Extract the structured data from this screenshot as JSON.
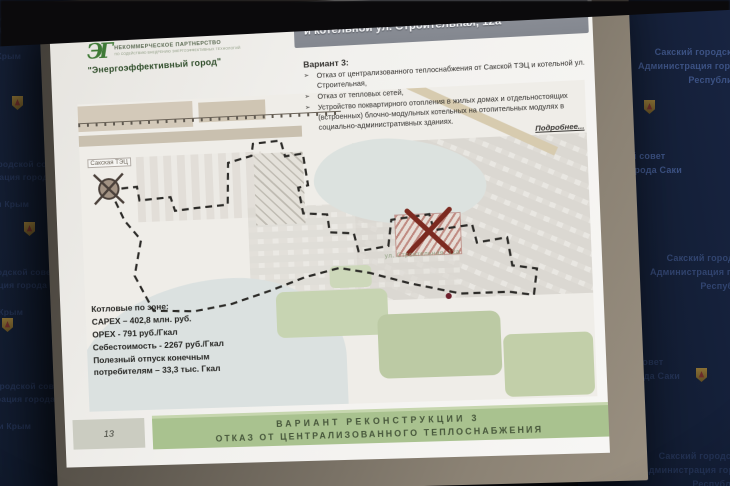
{
  "scene": {
    "wall": {
      "line1": "Сакский городской совет",
      "line2": "Администрация города Саки",
      "line3": "Республики Крым"
    }
  },
  "slide": {
    "page_number": "13",
    "logo": {
      "monogram": "ЭГ",
      "org_type": "НЕКОММЕРЧЕСКОЕ ПАРТНЕРСТВО",
      "org_subtitle": "ПО СОДЕЙСТВИЮ ВНЕДРЕНИЮ ЭНЕРГОЭФФЕКТИВНЫХ ТЕХНОЛОГИЙ",
      "org_name": "\"Энергоэффективный город\""
    },
    "title": {
      "line1": "Зона теплоснабжения Сакской ТЭЦ",
      "line2": "и котельной ул. Строительная, 12а"
    },
    "variant": {
      "heading": "Вариант 3:",
      "bullet_marker": "➢",
      "bullets": [
        "Отказ от централизованного теплоснабжения от Сакской ТЭЦ и котельной ул. Строительная,",
        "Отказ от тепловых сетей,",
        "Устройство поквартирного отопления в жилых домах и отдельностоящих (встроенных) блочно-модульных котельных на отопительных модулях в социально-административных зданиях."
      ],
      "more_link": "Подробнее..."
    },
    "map": {
      "tpp_label": "Сакская ТЭЦ",
      "boiler_label": "ул. Строительная, 12а"
    },
    "stats": {
      "heading": "Котловые по зоне:",
      "lines": [
        "CAPEX – 402,8 млн. руб.",
        "OPEX - 791 руб./Гкал",
        "Себестоимость - 2267 руб./Гкал",
        "Полезный отпуск конечным",
        "потребителям – 33,3 тыс. Гкал"
      ]
    },
    "footer": {
      "line1": "ВАРИАНТ РЕКОНСТРУКЦИИ 3",
      "line2": "ОТКАЗ ОТ ЦЕНТРАЛИЗОВАННОГО ТЕПЛОСНАБЖЕНИЯ"
    },
    "colors": {
      "footer_green": "#a9c28f",
      "title_box_gray": "#8a8e96",
      "zone_boundary": "#2b2a27",
      "closed_mark_red": "#7c2a20"
    }
  }
}
